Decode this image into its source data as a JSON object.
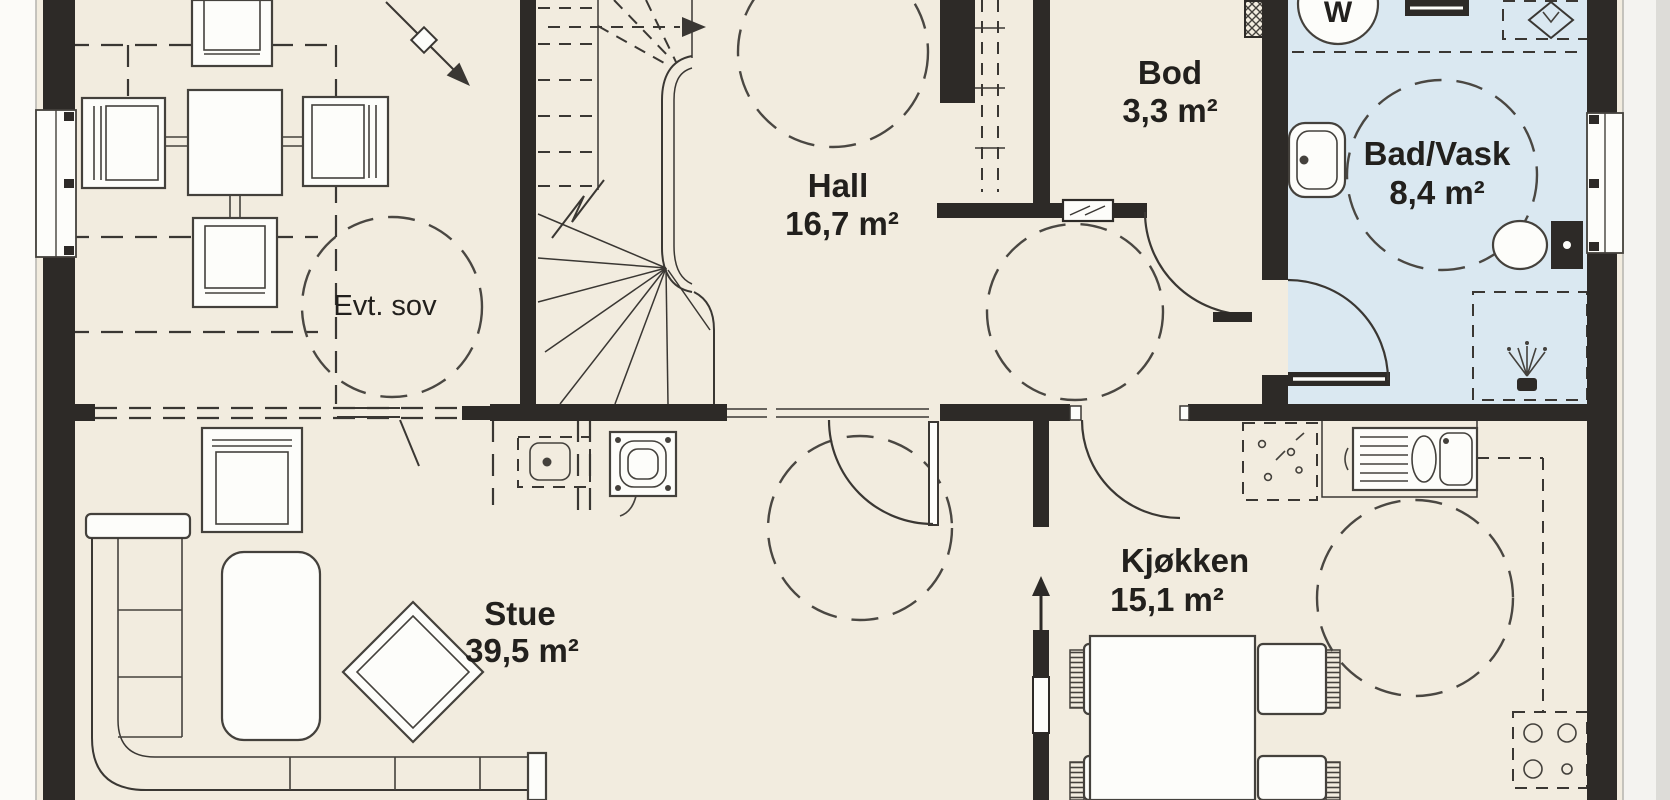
{
  "rooms": {
    "evt_sov": {
      "name": "Evt. sov"
    },
    "hall": {
      "name": "Hall",
      "area": "16,7 m²"
    },
    "bod": {
      "name": "Bod",
      "area": "3,3 m²"
    },
    "bad_vask": {
      "name": "Bad/Vask",
      "area": "8,4 m²"
    },
    "stue": {
      "name": "Stue",
      "area": "39,5 m²"
    },
    "kjokken": {
      "name": "Kjøkken",
      "area": "15,1 m²"
    }
  },
  "appliances": {
    "washing_machine_label": "W"
  },
  "icons": {
    "washing_machine": "circle-W",
    "water_heater": "dashed-box-diamond",
    "shower": "shower-head-spray",
    "stove": "dashed-box-4-burners",
    "chimney": "square-rings-dots",
    "fireplace": "dashed-box-stove",
    "vent": "wall-rect-diagonal"
  },
  "colors": {
    "wall": "#2d2a27",
    "floor": "#f2ecdf",
    "bathroom_floor": "#dae8f1",
    "line": "#3a3733",
    "text": "#22201d",
    "background": "#fcfbf8"
  }
}
